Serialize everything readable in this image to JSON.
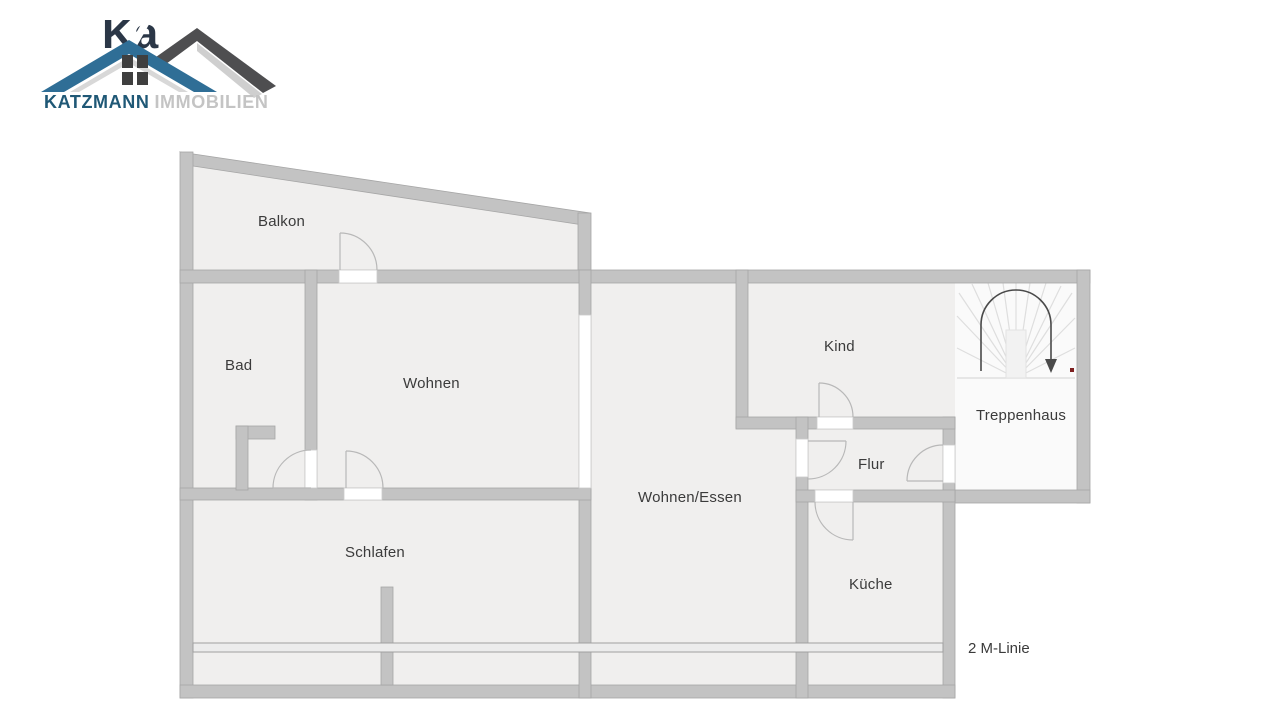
{
  "logo": {
    "brand_primary": "KATZMANN",
    "brand_secondary": "IMMOBILIEN",
    "watermark_fragment": "Ka",
    "colors": {
      "roof_blue": "#2f6e96",
      "roof_dark": "#4e4e50",
      "brand_primary_color": "#1f5876",
      "brand_secondary_color": "#c4c4c4"
    }
  },
  "floorplan": {
    "rooms": {
      "balkon": {
        "label": "Balkon"
      },
      "bad": {
        "label": "Bad"
      },
      "wohnen": {
        "label": "Wohnen"
      },
      "kind": {
        "label": "Kind"
      },
      "treppenhaus": {
        "label": "Treppenhaus"
      },
      "flur": {
        "label": "Flur"
      },
      "wohnen_essen": {
        "label": "Wohnen/Essen"
      },
      "schlafen": {
        "label": "Schlafen"
      },
      "kueche": {
        "label": "Küche"
      }
    },
    "annotations": {
      "m_linie": {
        "label": "2 M-Linie"
      }
    },
    "colors": {
      "wall": "#c3c3c3",
      "room_fill": "#f0efee",
      "stair_fill": "#fafafa",
      "arrow": "#4a4a4a",
      "red_marker": "#7d1f1f"
    }
  }
}
